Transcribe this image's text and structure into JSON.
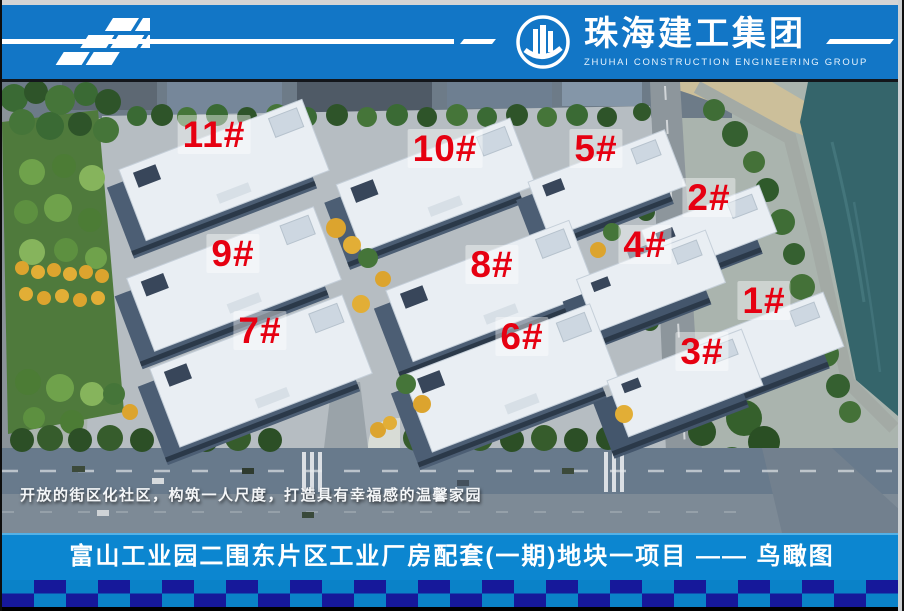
{
  "header": {
    "company_name_zh": "珠海建工集团",
    "company_name_en": "ZHUHAI  CONSTRUCTION  ENGINEERING  GROUP"
  },
  "scene": {
    "type": "aerial-bird-eye-rendering",
    "caption": "开放的街区化社区，构筑一人尺度，打造具有幸福感的温馨家园"
  },
  "buildings": [
    {
      "label": "1#"
    },
    {
      "label": "2#"
    },
    {
      "label": "3#"
    },
    {
      "label": "4#"
    },
    {
      "label": "5#"
    },
    {
      "label": "6#"
    },
    {
      "label": "7#"
    },
    {
      "label": "8#"
    },
    {
      "label": "9#"
    },
    {
      "label": "10#"
    },
    {
      "label": "11#"
    }
  ],
  "footer": {
    "title": "富山工业园二围东片区工业厂房配套(一期)地块一项目 —— 鸟瞰图"
  },
  "colors": {
    "header_blue": "#1276c6",
    "footer_blue": "#0c86d0",
    "checker_navy": "#16189a",
    "checker_blue": "#0a82c8",
    "label_red": "#e60011",
    "water_teal": "#35656b"
  },
  "icons": {
    "brand_pattern": "checker-flag-pattern",
    "logo": "building-circle-icon"
  }
}
